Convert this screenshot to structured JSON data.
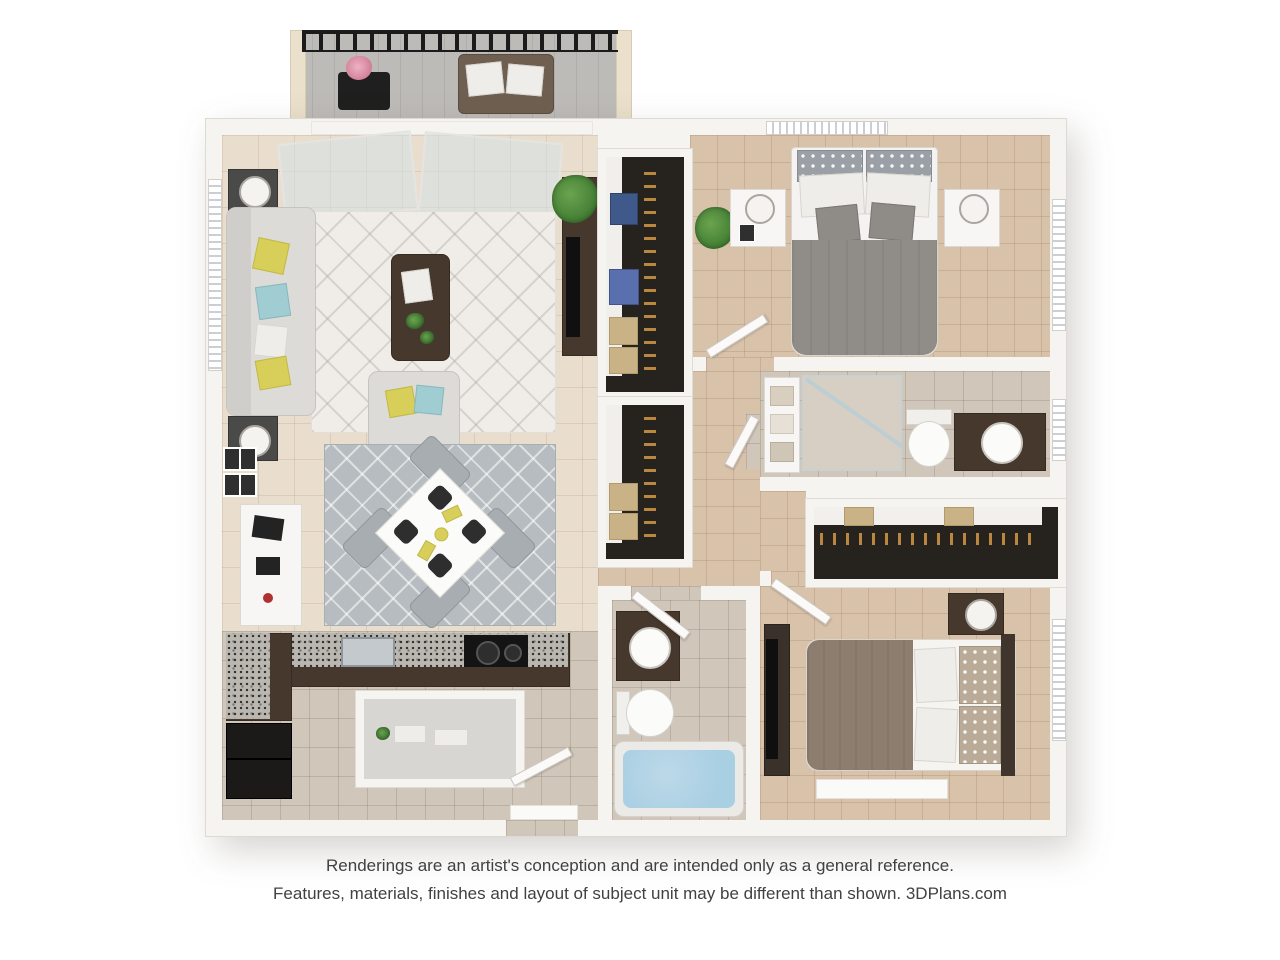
{
  "disclaimer": {
    "line1": "Renderings are an artist's conception and are intended only as a general reference.",
    "line2": "Features, materials, finishes and layout of subject unit may be different than shown. 3DPlans.com"
  },
  "floor_plan": {
    "type": "3d-rendered-apartment-floor-plan",
    "rooms": [
      "balcony",
      "living-room",
      "dining-area",
      "kitchen",
      "hallway",
      "walk-in-closet",
      "second-closet",
      "bedroom-1",
      "bathroom-1",
      "bedroom-2-closet",
      "bathroom-2",
      "bedroom-2"
    ],
    "colors": {
      "wall": "#f6f4f1",
      "living_tile": "#e9ddcd",
      "bedroom_tile": "#d8c2aa",
      "bath_tile": "#d0c6ba",
      "cabinet_wood": "#46382c",
      "accent_yellow": "#d8cf5a",
      "accent_teal": "#9fcdd1",
      "bathtub_water": "#a9cfe3",
      "plant_green": "#4e8b3c",
      "railing_black": "#1c1c1c",
      "text_gray": "#414141"
    }
  }
}
